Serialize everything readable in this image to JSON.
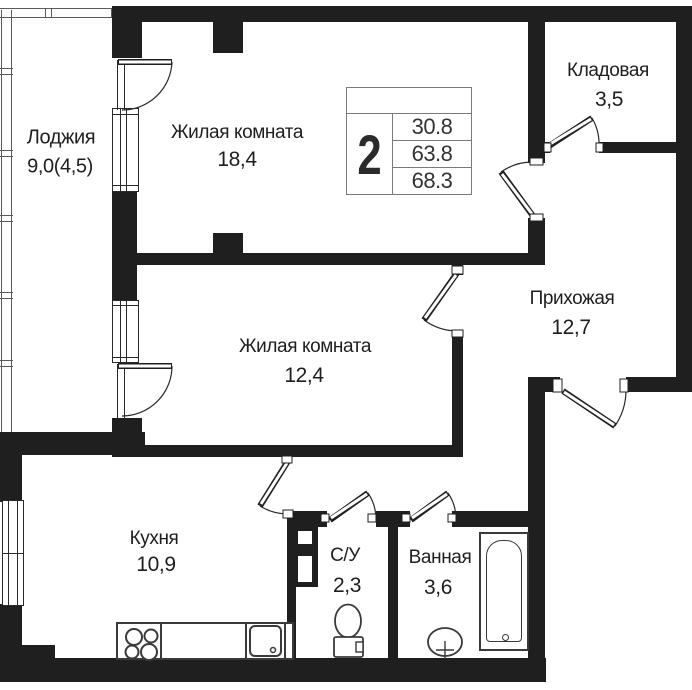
{
  "plan": {
    "title_block": {
      "rooms_count": "2",
      "values": [
        "30.8",
        "63.8",
        "68.3"
      ]
    },
    "rooms": [
      {
        "id": "loggia",
        "name": "Лоджия",
        "area": "9,0(4,5)"
      },
      {
        "id": "living-room-1",
        "name": "Жилая комната",
        "area": "18,4"
      },
      {
        "id": "storage",
        "name": "Кладовая",
        "area": "3,5"
      },
      {
        "id": "hallway",
        "name": "Прихожая",
        "area": "12,7"
      },
      {
        "id": "living-room-2",
        "name": "Жилая комната",
        "area": "12,4"
      },
      {
        "id": "kitchen",
        "name": "Кухня",
        "area": "10,9"
      },
      {
        "id": "wc",
        "name": "С/У",
        "area": "2,3"
      },
      {
        "id": "bathroom",
        "name": "Ванная",
        "area": "3,6"
      }
    ],
    "colors": {
      "wall": "#1f1f1f",
      "fixture_line": "#3a3a3a",
      "table_border": "#7b7b7b",
      "text": "#1e1e1e"
    }
  }
}
